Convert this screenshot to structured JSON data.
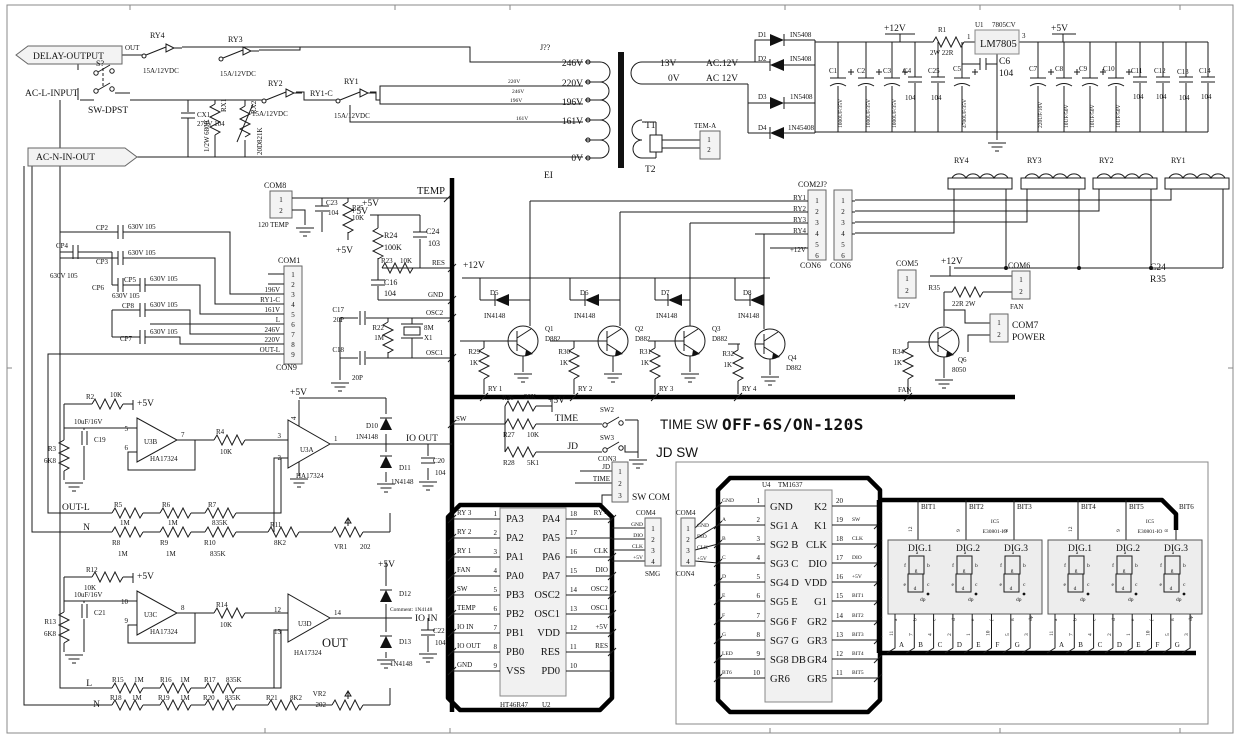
{
  "c": {
    "a15": "15A/12VDC",
    "i4148": "IN4148",
    "n4148": "1N4148",
    "d882": "D882",
    "k1": "1K",
    "m1": "1M",
    "k835": "835K",
    "c104": "104",
    "cp": "630V 105",
    "ha": "HA17324",
    "e1000": "1000UF/35V",
    "u1050": "10UF/50V",
    "k10": "10K",
    "k82": "8K2",
    "v202": "202",
    "k68": "6K8",
    "u10": "10uF/16V",
    "i5408": "IN5408",
    "v5": "+5V",
    "v12": "+12V",
    "gnd": "GND",
    "dio": "DIO",
    "clk": "CLK",
    "fan": "FAN",
    "time": "TIME",
    "jd": "JD",
    "sw": "SW",
    "temp": "TEMP",
    "res": "RES",
    "osc1": "OSC1",
    "osc2": "OSC2",
    "com4": "COM4",
    "con4": "CON4",
    "con6": "CON6",
    "p20": "20P",
    "n": "N",
    "l": "L",
    "outl": "OUT-L",
    "ic5": "IC5",
    "e30801": "E30801-IO",
    "dig1": "DIG.1",
    "dig2": "DIG.2",
    "dig3": "DIG.3"
  },
  "p": {
    "1": "1",
    "2": "2",
    "3": "3",
    "4": "4",
    "5": "5",
    "6": "6",
    "7": "7",
    "8": "8",
    "9": "9",
    "10": "10",
    "11": "11",
    "12": "12",
    "13": "13",
    "14": "14",
    "15": "15",
    "16": "16",
    "17": "17",
    "18": "18",
    "19": "19",
    "20": "20"
  },
  "seg": {
    "a": "a",
    "b": "b",
    "c": "c",
    "d": "d",
    "e": "e",
    "f": "f",
    "g": "g",
    "dp": "dp"
  },
  "sn": {
    "a": "11",
    "b": "7",
    "c": "4",
    "d": "2",
    "e": "1",
    "f": "10",
    "g": "5",
    "dp": "3"
  },
  "lt": {
    "A": "A",
    "B": "B",
    "C": "C",
    "D": "D",
    "E": "E",
    "F": "F",
    "G": "G"
  },
  "bit": {
    "1": "BIT1",
    "2": "BIT2",
    "3": "BIT3",
    "4": "BIT4",
    "5": "BIT5",
    "6": "BIT6"
  },
  "inp": {
    "delay": "DELAY-OUTPUT",
    "out": "OUT",
    "s": "S?",
    "dpst": "SW-DPST",
    "acl": "AC-L-INPUT",
    "acn": "AC-N-IN-OUT",
    "ry1": "RY1",
    "ry2": "RY2",
    "ry3": "RY3",
    "ry4": "RY4",
    "ry1c": "RY1-C",
    "cx1": "CX1",
    "cx1v": "275V 104",
    "rx1": "RX1",
    "rx1v": "1/2W 680K",
    "rx2": "RX2",
    "rx2v": "20D821K"
  },
  "tr": {
    "j": "J??",
    "v246": "246V",
    "v220": "220V",
    "v196": "196V",
    "v161": "161V",
    "v0": "0V",
    "t1": "T1",
    "t2": "T2",
    "ei": "EI",
    "tem": "TEM-A",
    "v13": "13V",
    "ac12": "AC:12V",
    "ac12b": "AC 12V"
  },
  "re": {
    "d1": "D1",
    "d2": "D2",
    "d3": "D3",
    "d4": "D4",
    "n5408": "1N5408",
    "n45408": "1N45408"
  },
  "ps": {
    "r1": "R1",
    "r1v": "2W 22R",
    "u1": "U1",
    "u1t": "7805CV",
    "lm": "LM7805",
    "c1": "C1",
    "c2": "C2",
    "c3": "C3",
    "c4": "C4",
    "c25": "C25",
    "c5": "C5",
    "c5v": "4700UF/35V",
    "c6": "C6",
    "c7": "C7",
    "c7v": "220UF/16V",
    "c8": "C8",
    "c9": "C9",
    "c10": "C10",
    "c11": "C11",
    "c12": "C12",
    "c13": "C13",
    "c14": "C14"
  },
  "ts": {
    "com8": "COM8",
    "t120": "120 TEMP",
    "c23": "C23",
    "r25": "R25",
    "r24": "R24",
    "r24v": "100K",
    "c24": "C24",
    "c24v": "103",
    "r23": "R23",
    "c16": "C16",
    "c17": "C17",
    "r22": "R22",
    "x1": "X1",
    "x1v": "8M",
    "c18": "C18"
  },
  "k1": {
    "t": "COM1",
    "con": "CON9"
  },
  "cpc": {
    "cp2": "CP2",
    "cp3": "CP3",
    "cp4": "CP4",
    "cp5": "CP5",
    "cp6": "CP6",
    "cp7": "CP7",
    "cp8": "CP8"
  },
  "dv": {
    "d5": "D5",
    "d6": "D6",
    "d7": "D7",
    "d8": "D8",
    "q1": "Q1",
    "q2": "Q2",
    "q3": "Q3",
    "q4": "Q4",
    "r29": "R29",
    "r30": "R30",
    "r31": "R31",
    "r32": "R32",
    "ry1": "RY 1",
    "ry2": "RY 2",
    "ry3": "RY 3",
    "ry4": "RY 4",
    "com2j": "COM2J?",
    "com5": "COM5",
    "com6": "COM6",
    "com7": "COM7",
    "power": "POWER",
    "q6": "Q6",
    "q6v": "8050",
    "r34": "R34",
    "r35": "R35",
    "r35v": "22R 2W",
    "c24": "C24"
  },
  "a1": {
    "r2": "R2",
    "c19": "C19",
    "r3": "R3",
    "u3b": "U3B",
    "r4": "R4",
    "u3a": "U3A",
    "d10": "D10",
    "ioout": "IO OUT",
    "d11": "D11",
    "c20": "C20",
    "r5": "R5",
    "r6": "R6",
    "r7": "R7",
    "r8": "R8",
    "r9": "R9",
    "r10": "R10",
    "r11": "R11",
    "vr1": "VR1"
  },
  "a2": {
    "r12": "R12",
    "c21": "C21",
    "r13": "R13",
    "u3c": "U3C",
    "r14": "R14",
    "u3d": "U3D",
    "out": "OUT",
    "d12": "D12",
    "cm": "Comment: 1N4148",
    "ioin": "IO IN",
    "d13": "D13",
    "c22": "C22",
    "r15": "R15",
    "r16": "R16",
    "r17": "R17",
    "r18": "R18",
    "r19": "R19",
    "r20": "R20",
    "r21": "R21",
    "vr2": "VR2"
  },
  "sx": {
    "r26": "R26",
    "r26v": "20K",
    "r27": "R27",
    "r28": "R28",
    "r28v": "5K1",
    "sw2": "SW2",
    "sw3": "SW3",
    "con3": "CON3",
    "swcom": "SW COM",
    "title": "TIME SW",
    "mode": "OFF-6S/ON-120S",
    "jdsw": "JD SW"
  },
  "u2": {
    "part": "HT46R47",
    "ref": "U2",
    "l": [
      [
        "1",
        "PA3",
        "RY 3"
      ],
      [
        "2",
        "PA2",
        "RY 2"
      ],
      [
        "3",
        "PA1",
        "RY 1"
      ],
      [
        "4",
        "PA0",
        "FAN"
      ],
      [
        "5",
        "PB3",
        "SW"
      ],
      [
        "6",
        "PB2",
        "TEMP"
      ],
      [
        "7",
        "PB1",
        "IO IN"
      ],
      [
        "8",
        "PB0",
        "IO OUT"
      ],
      [
        "9",
        "VSS",
        "GND"
      ]
    ],
    "r": [
      [
        "18",
        "PA4",
        "RY 4"
      ],
      [
        "17",
        "PA5",
        ""
      ],
      [
        "16",
        "PA6",
        "CLK"
      ],
      [
        "15",
        "PA7",
        "DIO"
      ],
      [
        "14",
        "OSC2",
        "OSC2"
      ],
      [
        "13",
        "OSC1",
        "OSC1"
      ],
      [
        "12",
        "VDD",
        "+5V"
      ],
      [
        "11",
        "RES",
        "RES"
      ],
      [
        "10",
        "PD0",
        ""
      ]
    ]
  },
  "u4": {
    "ref": "U4",
    "part": "TM1637",
    "smg": "SMG",
    "l": [
      [
        "1",
        "GND",
        "GND"
      ],
      [
        "2",
        "SG1 A",
        "A"
      ],
      [
        "3",
        "SG2 B",
        "B"
      ],
      [
        "4",
        "SG3 C",
        "C"
      ],
      [
        "5",
        "SG4 D",
        "D"
      ],
      [
        "6",
        "SG5 E",
        "E"
      ],
      [
        "7",
        "SG6 F",
        "F"
      ],
      [
        "8",
        "SG7 G",
        "G"
      ],
      [
        "9",
        "SG8 DB",
        "LED"
      ],
      [
        "10",
        "GR6",
        "BT6"
      ]
    ],
    "r": [
      [
        "20",
        "K2",
        ""
      ],
      [
        "19",
        "K1",
        "SW"
      ],
      [
        "18",
        "CLK",
        "CLK"
      ],
      [
        "17",
        "DIO",
        "DIO"
      ],
      [
        "16",
        "VDD",
        "+5V"
      ],
      [
        "15",
        "G1",
        "BIT1"
      ],
      [
        "14",
        "GR2",
        "BIT2"
      ],
      [
        "13",
        "GR3",
        "BIT3"
      ],
      [
        "12",
        "GR4",
        "BIT4"
      ],
      [
        "11",
        "GR5",
        "BIT5"
      ]
    ]
  },
  "dsp": {
    "pn1": "12",
    "pn2": "9",
    "pn3": "8"
  }
}
